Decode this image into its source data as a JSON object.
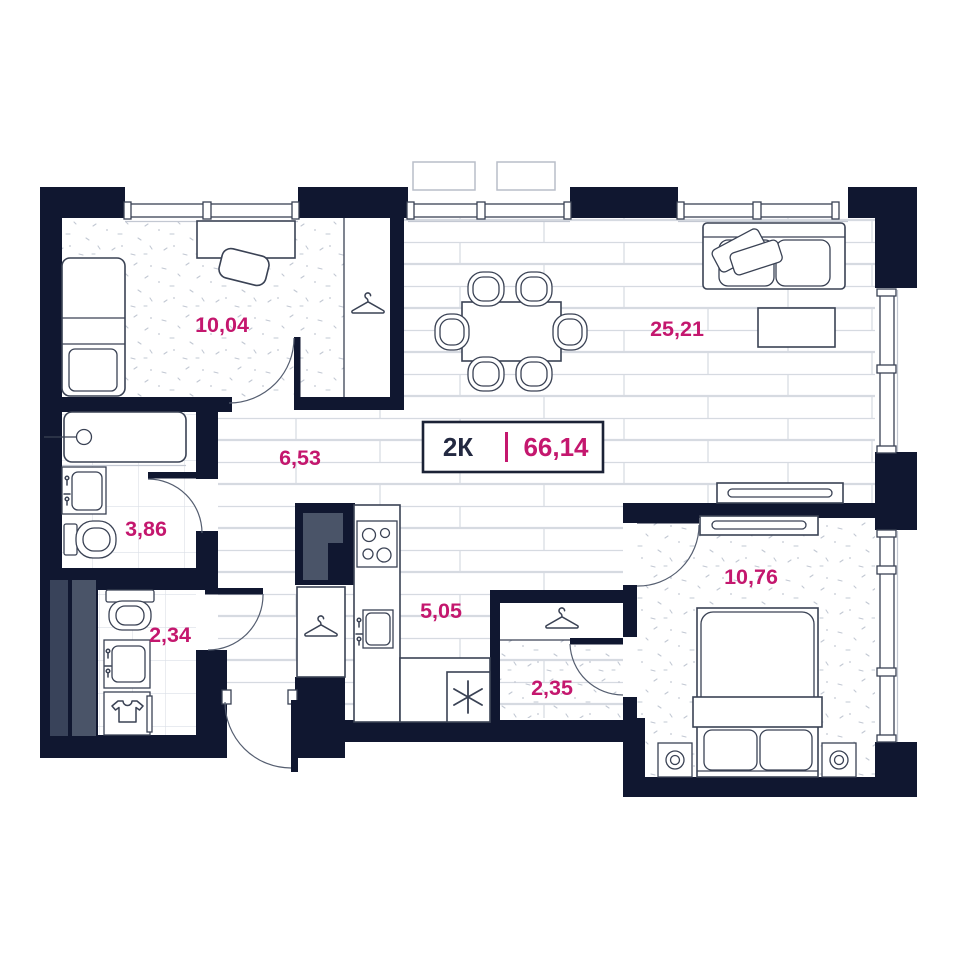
{
  "title": {
    "rooms_label": "2К",
    "divider": "|",
    "total_area": "66,14"
  },
  "rooms": [
    {
      "id": "bedroom-office",
      "area": "10,04"
    },
    {
      "id": "living-room",
      "area": "25,21"
    },
    {
      "id": "hallway",
      "area": "6,53"
    },
    {
      "id": "bathroom",
      "area": "3,86"
    },
    {
      "id": "toilet-laundry",
      "area": "2,34"
    },
    {
      "id": "kitchen",
      "area": "5,05"
    },
    {
      "id": "wardrobe",
      "area": "2,35"
    },
    {
      "id": "bedroom",
      "area": "10,76"
    }
  ],
  "icons": {
    "hanger": "hanger-icon",
    "snowflake": "fridge-snowflake-icon",
    "tshirt": "laundry-tshirt-icon"
  },
  "colors": {
    "wall": "#101730",
    "accent": "#c4176e",
    "title": "#232941",
    "fur": "#3a4254",
    "duct": "#4a5468",
    "duct2": "#39435a"
  }
}
